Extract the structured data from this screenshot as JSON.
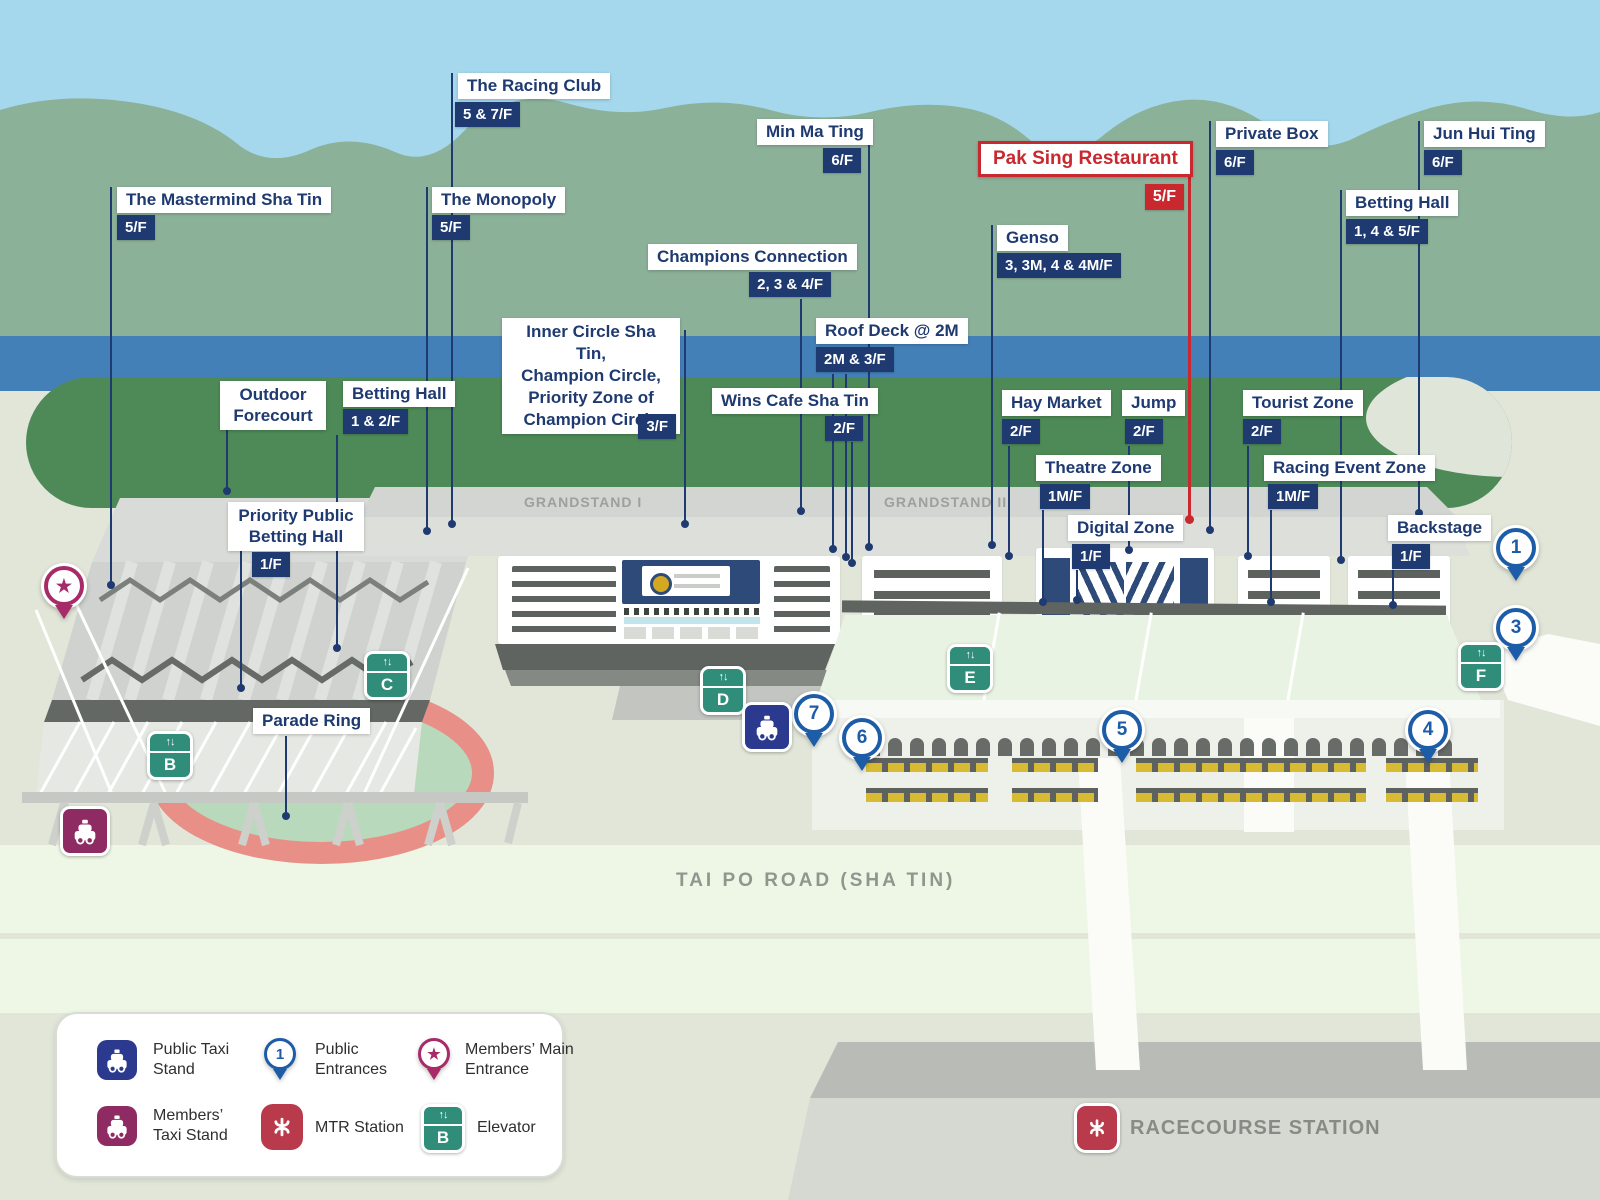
{
  "map": {
    "grandstand1": "GRANDSTAND I",
    "grandstand2": "GRANDSTAND II",
    "road": "TAI PO ROAD (SHA TIN)",
    "station": "RACECOURSE STATION"
  },
  "callouts": [
    {
      "id": "mastermind",
      "label": "The Mastermind Sha Tin",
      "floor": "5/F"
    },
    {
      "id": "racing-club",
      "label": "The Racing Club",
      "floor": "5 & 7/F"
    },
    {
      "id": "monopoly",
      "label": "The Monopoly",
      "floor": "5/F"
    },
    {
      "id": "min-ma-ting",
      "label": "Min Ma Ting",
      "floor": "6/F"
    },
    {
      "id": "champions-connection",
      "label": "Champions Connection",
      "floor": "2, 3 & 4/F"
    },
    {
      "id": "inner-circle",
      "label": "Inner Circle Sha Tin,\nChampion Circle,\nPriority Zone of\nChampion Circle",
      "floor": "3/F"
    },
    {
      "id": "roof-deck",
      "label": "Roof Deck @ 2M",
      "floor": "2M & 3/F"
    },
    {
      "id": "wins-cafe",
      "label": "Wins Cafe Sha Tin",
      "floor": "2/F"
    },
    {
      "id": "genso",
      "label": "Genso",
      "floor": "3, 3M, 4 & 4M/F"
    },
    {
      "id": "pak-sing",
      "label": "Pak Sing Restaurant",
      "floor": "5/F",
      "highlight": "red"
    },
    {
      "id": "private-box",
      "label": "Private Box",
      "floor": "6/F"
    },
    {
      "id": "jun-hui-ting",
      "label": "Jun Hui Ting",
      "floor": "6/F"
    },
    {
      "id": "betting-hall-east",
      "label": "Betting Hall",
      "floor": "1, 4 & 5/F"
    },
    {
      "id": "outdoor-forecourt",
      "label": "Outdoor Forecourt",
      "floor": null
    },
    {
      "id": "betting-hall-west",
      "label": "Betting Hall",
      "floor": "1 & 2/F"
    },
    {
      "id": "priority-public-betting-hall",
      "label": "Priority Public Betting Hall",
      "floor": "1/F"
    },
    {
      "id": "parade-ring",
      "label": "Parade Ring",
      "floor": null
    },
    {
      "id": "hay-market",
      "label": "Hay Market",
      "floor": "2/F"
    },
    {
      "id": "jump",
      "label": "Jump",
      "floor": "2/F"
    },
    {
      "id": "tourist-zone",
      "label": "Tourist Zone",
      "floor": "2/F"
    },
    {
      "id": "theatre-zone",
      "label": "Theatre Zone",
      "floor": "1M/F"
    },
    {
      "id": "racing-event-zone",
      "label": "Racing Event Zone",
      "floor": "1M/F"
    },
    {
      "id": "digital-zone",
      "label": "Digital Zone",
      "floor": "1/F"
    },
    {
      "id": "backstage",
      "label": "Backstage",
      "floor": "1/F"
    }
  ],
  "entrances": {
    "e1": "1",
    "e3": "3",
    "e4": "4",
    "e5": "5",
    "e6": "6",
    "e7": "7"
  },
  "elevators": {
    "b": "B",
    "c": "C",
    "d": "D",
    "e": "E",
    "f": "F"
  },
  "legend": {
    "items": [
      {
        "icon": "public-taxi-icon",
        "label": "Public Taxi Stand"
      },
      {
        "icon": "public-entrance-pin-icon",
        "label": "Public Entrances"
      },
      {
        "icon": "members-main-entrance-pin-icon",
        "label": "Members’ Main Entrance"
      },
      {
        "icon": "members-taxi-icon",
        "label": "Members’ Taxi Stand"
      },
      {
        "icon": "mtr-icon",
        "label": "MTR Station"
      },
      {
        "icon": "elevator-icon",
        "label": "Elevator"
      }
    ],
    "elevator_sample_letter": "B",
    "entrance_sample_number": "1"
  },
  "colors": {
    "navy": "#1e3a70",
    "highlight_red": "#c8282e",
    "elevator_teal": "#2f8d7a",
    "entrance_blue": "#1d5ca7",
    "members_magenta": "#a62b68",
    "taxi_blue": "#2b3a8f",
    "taxi_magenta": "#8e2b63",
    "mtr_red": "#b93a4a"
  }
}
